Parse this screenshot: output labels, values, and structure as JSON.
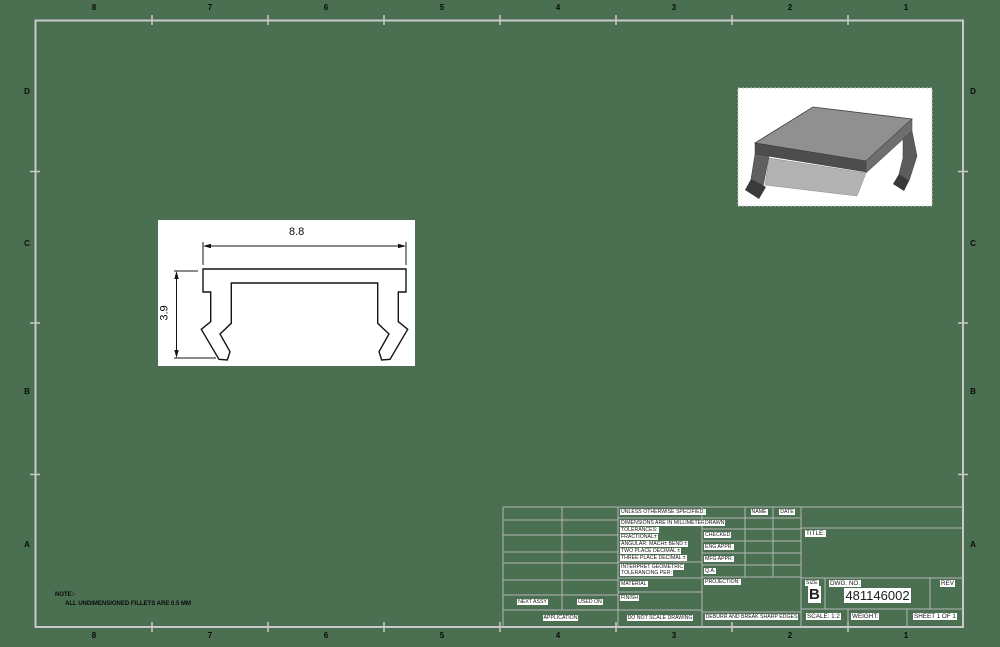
{
  "sheet": {
    "background_color": "#4a7051",
    "border_color": "#c9c9c9",
    "zone_columns": [
      "8",
      "7",
      "6",
      "5",
      "4",
      "3",
      "2",
      "1"
    ],
    "zone_rows": [
      "D",
      "C",
      "B",
      "A"
    ]
  },
  "note": {
    "heading": "NOTE:-",
    "body": "ALL UNDIMENSIONED FILLETS ARE 0.5 MM"
  },
  "front_view": {
    "width_dim": "8.8",
    "height_dim": "3.9"
  },
  "title_block": {
    "unless": "UNLESS OTHERWISE SPECIFIED:",
    "tolerances": [
      "DIMENSIONS ARE IN MILLIMETERS",
      "TOLERANCES:",
      "FRACTIONAL±",
      "ANGULAR: MACH±  BEND ±",
      "TWO PLACE DECIMAL   ±",
      "THREE PLACE DECIMAL ±"
    ],
    "interpret_1": "INTERPRET GEOMETRIC",
    "interpret_2": "TOLERANCING PER:",
    "material": "MATERIAL",
    "finish": "FINISH",
    "do_not_scale": "DO NOT SCALE DRAWING",
    "approval_rows": [
      "DRAWN",
      "CHECKED",
      "ENG APPR.",
      "MFG APPR.",
      "Q.A.",
      "PROJECTION:"
    ],
    "name_header": "NAME",
    "date_header": "DATE",
    "deburr": "DEBURR AND BREAK SHARP EDGES",
    "next_assy": "NEXT ASSY",
    "used_on": "USED ON",
    "application": "APPLICATION",
    "title_label": "TITLE:",
    "size_label": "SIZE",
    "size_value": "B",
    "dwg_no_label": "DWG. NO.",
    "dwg_no_value": "481146002",
    "rev_label": "REV",
    "scale_text": "SCALE: 1:2",
    "weight_label": "WEIGHT:",
    "sheet_text": "SHEET 1 OF 1"
  }
}
